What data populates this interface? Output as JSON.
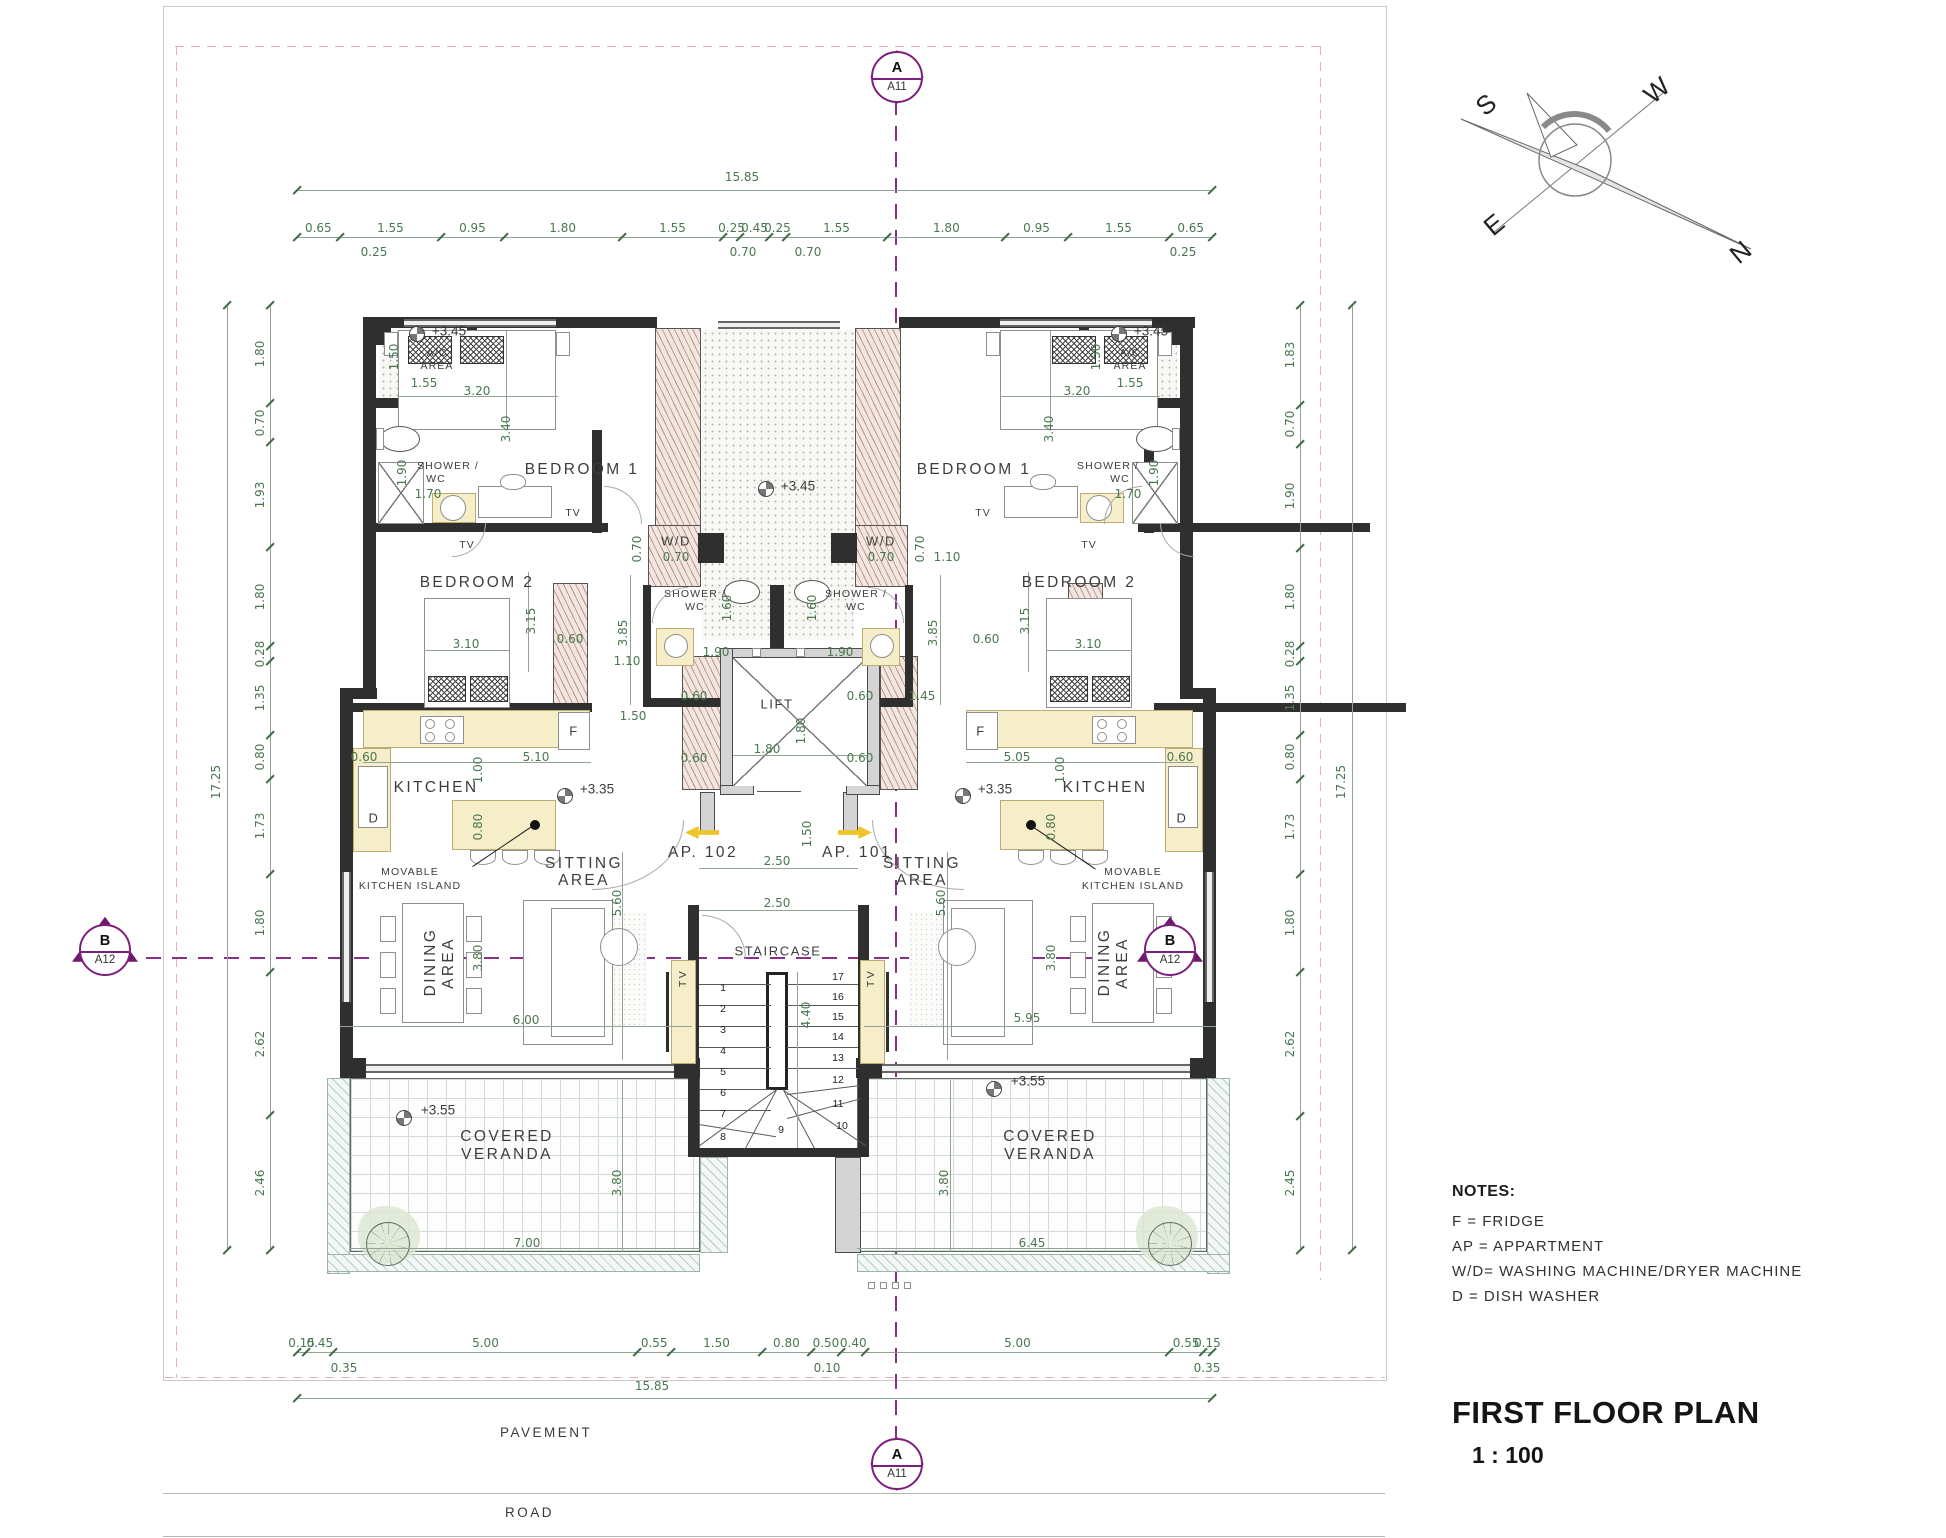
{
  "colors": {
    "accent_purple": "#7d1f7d",
    "dimension_green": "#49784f",
    "wall_dark": "#2f2f2f",
    "furniture_yellow": "#f6eec9",
    "hatch_tan": "#c89a82",
    "arrow_yellow": "#eec527"
  },
  "title_block": {
    "title": "FIRST FLOOR PLAN",
    "scale": "1 : 100"
  },
  "notes": {
    "heading": "NOTES:",
    "lines": [
      "F = FRIDGE",
      "AP = APPARTMENT",
      "W/D= WASHING MACHINE/DRYER MACHINE",
      "D = DISH WASHER"
    ]
  },
  "markers": {
    "section_a": {
      "letter": "A",
      "sheet": "A11"
    },
    "section_b": {
      "letter": "B",
      "sheet": "A12"
    }
  },
  "compass": {
    "n": "N",
    "s": "S",
    "e": "E",
    "w": "W"
  },
  "site": {
    "pavement": "PAVEMENT",
    "road": "ROAD"
  },
  "apartments": {
    "left_no": "AP. 102",
    "right_no": "AP. 101"
  },
  "rooms": {
    "bedroom1": "BEDROOM 1",
    "bedroom2": "BEDROOM 2",
    "kitchen": "KITCHEN",
    "sitting1": "SITTING",
    "sitting2": "AREA",
    "dining1": "DINING",
    "dining2": "AREA",
    "veranda1": "COVERED",
    "veranda2": "VERANDA",
    "staircase": "STAIRCASE",
    "lift": "LIFT",
    "shower1": "SHOWER /",
    "shower2": "WC",
    "ac1": "A/C",
    "ac2": "AREA",
    "wd": "W/D",
    "island1": "MOVABLE",
    "island2": "KITCHEN ISLAND",
    "tv": "TV",
    "fridge": "F",
    "dishwasher": "D"
  },
  "levels": {
    "l345": "+3.45",
    "l335": "+3.35",
    "l355": "+3.55"
  },
  "stairs": {
    "left": [
      "1",
      "2",
      "3",
      "4",
      "5",
      "6",
      "7",
      "8"
    ],
    "right": [
      "17",
      "16",
      "15",
      "14",
      "13",
      "12",
      "11",
      "10"
    ],
    "bottom": "9"
  },
  "dims": {
    "d060": "0.60",
    "d070": "0.70",
    "d080": "0.80",
    "d100": "1.00",
    "d110": "1.10",
    "d145": "1.45",
    "d150": "1.50",
    "d155": "1.55",
    "d160": "1.60",
    "d170": "1.70",
    "d180": "1.80",
    "d190": "1.90",
    "d250": "2.50",
    "d310": "3.10",
    "d315": "3.15",
    "d320": "3.20",
    "d340": "3.40",
    "d380": "3.80",
    "d385": "3.85",
    "d440": "4.40",
    "d505": "5.05",
    "d510": "5.10",
    "d560": "5.60",
    "d595": "5.95",
    "d600": "6.00",
    "d645": "6.45",
    "d700": "7.00"
  },
  "chains": {
    "top": {
      "total": "15.85",
      "segs": [
        "0.65",
        "1.55",
        "0.95",
        "1.80",
        "1.55",
        "0.25",
        "0.45",
        "0.25",
        "1.55",
        "1.80",
        "0.95",
        "1.55",
        "0.65"
      ],
      "sub_left": "0.25",
      "sub_mid1": "0.70",
      "sub_mid2": "0.70",
      "sub_right": "0.25"
    },
    "bottom": {
      "total": "15.85",
      "segs": [
        "0.15",
        "0.45",
        "5.00",
        "0.55",
        "1.50",
        "0.80",
        "0.50",
        "0.40",
        "5.00",
        "0.55",
        "0.15"
      ],
      "sub_left": "0.35",
      "sub_mid": "0.10",
      "sub_right": "0.35"
    },
    "left": {
      "total": "17.25",
      "segs": [
        "1.80",
        "0.70",
        "1.93",
        "1.80",
        "0.28",
        "1.35",
        "0.80",
        "1.73",
        "1.80",
        "2.62",
        "2.46"
      ]
    },
    "right": {
      "total": "17.25",
      "segs": [
        "1.83",
        "0.70",
        "1.90",
        "1.80",
        "0.28",
        "1.35",
        "0.80",
        "1.73",
        "1.80",
        "2.62",
        "2.45"
      ]
    }
  }
}
